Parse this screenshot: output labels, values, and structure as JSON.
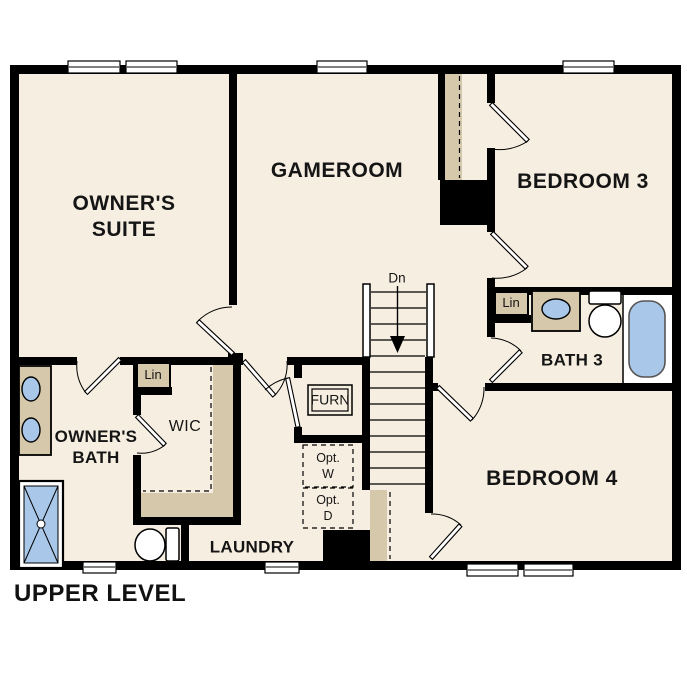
{
  "title": "UPPER LEVEL",
  "colors": {
    "floor": "#f6eee1",
    "wall": "#000000",
    "tan": "#d5c8ab",
    "fixture_blue": "#a9c7e8",
    "opt_gray": "#e3e3e3",
    "page_bg": "#ffffff"
  },
  "rooms": {
    "owners_suite": {
      "line1": "OWNER'S",
      "line2": "SUITE"
    },
    "gameroom": {
      "label": "GAMEROOM"
    },
    "bedroom3": {
      "label": "BEDROOM 3"
    },
    "bath3": {
      "label": "BATH 3"
    },
    "bedroom4": {
      "label": "BEDROOM 4"
    },
    "owners_bath": {
      "line1": "OWNER'S",
      "line2": "BATH"
    },
    "wic": {
      "label": "WIC"
    },
    "laundry": {
      "label": "LAUNDRY"
    }
  },
  "annotations": {
    "stairs_direction": "Dn",
    "furnace": "FURN",
    "opt_washer_line1": "Opt.",
    "opt_washer_line2": "W",
    "opt_dryer_line1": "Opt.",
    "opt_dryer_line2": "D",
    "linen_wic": "Lin",
    "linen_bath3": "Lin"
  }
}
